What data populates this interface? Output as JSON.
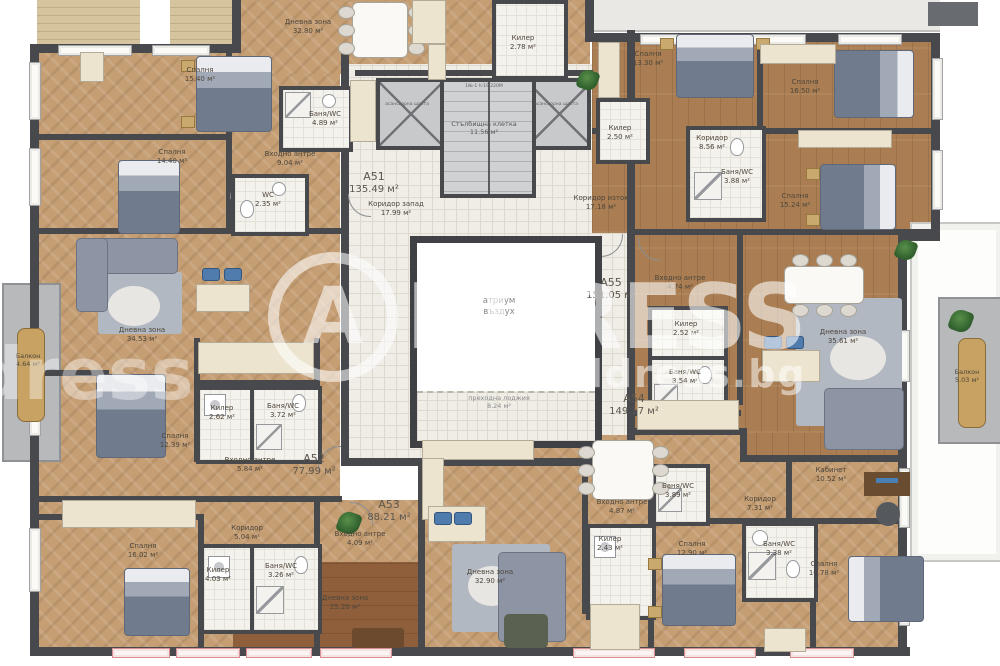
{
  "watermark": {
    "letter": "A",
    "word": "DDRESS",
    "word_partial": "address",
    "site": "address.bg"
  },
  "core": {
    "stair_name": "Стълбищна клетка",
    "stair_area": "11.56 м²",
    "stair_note": "1№-1 h:19,220М",
    "elevator": "асансьорна шахта",
    "atrium_line1": "атриум",
    "atrium_line2": "въздух",
    "loggia_name": "преходна лоджия",
    "loggia_area": "8.24 м²"
  },
  "apartments": [
    {
      "id": "A51",
      "area": "135.49 м²"
    },
    {
      "id": "A52",
      "area": "77.99 м²"
    },
    {
      "id": "A53",
      "area": "88.21 м²"
    },
    {
      "id": "A54",
      "area": "149.17 м²"
    },
    {
      "id": "A55",
      "area": "151.05 м²"
    }
  ],
  "rooms": [
    {
      "name": "Спалня",
      "area": "15.40 м²"
    },
    {
      "name": "Спалня",
      "area": "14.40 м²"
    },
    {
      "name": "Дневна зона",
      "area": "32.80 м²"
    },
    {
      "name": "Баня/WC",
      "area": "4.89 м²"
    },
    {
      "name": "Входно антре",
      "area": "9.04 м²"
    },
    {
      "name": "WC",
      "area": "2.35 м²"
    },
    {
      "name": "Килер",
      "area": "2.78 м²"
    },
    {
      "name": "Коридор запад",
      "area": "17.99 м²"
    },
    {
      "name": "Коридор изток",
      "area": "17.18 м²"
    },
    {
      "name": "Спалня",
      "area": "13.30 м²"
    },
    {
      "name": "Спалня",
      "area": "16.50 м²"
    },
    {
      "name": "Килер",
      "area": "2.50 м²"
    },
    {
      "name": "Коридор",
      "area": "8.56 м²"
    },
    {
      "name": "Баня/WC",
      "area": "3.88 м²"
    },
    {
      "name": "Спалня",
      "area": "15.24 м²"
    },
    {
      "name": "Входно антре",
      "area": "4.74 м²"
    },
    {
      "name": "Килер",
      "area": "2.52 м²"
    },
    {
      "name": "Баня/WC",
      "area": "3.54 м²"
    },
    {
      "name": "Дневна зона",
      "area": "35.61 м²"
    },
    {
      "name": "Балкон",
      "area": "4.64 м²"
    },
    {
      "name": "Балкон",
      "area": "5.03 м²"
    },
    {
      "name": "Дневна зона",
      "area": "34.53 м²"
    },
    {
      "name": "Килер",
      "area": "2.62 м²"
    },
    {
      "name": "Баня/WC",
      "area": "3.72 м²"
    },
    {
      "name": "Спалня",
      "area": "12.39 м²"
    },
    {
      "name": "Входно антре",
      "area": "5.84 м²"
    },
    {
      "name": "Спалня",
      "area": "16.02 м²"
    },
    {
      "name": "Коридор",
      "area": "5.04 м²"
    },
    {
      "name": "Килер",
      "area": "4.03 м²"
    },
    {
      "name": "Баня/WC",
      "area": "3.26 м²"
    },
    {
      "name": "Входно антре",
      "area": "4.09 м²"
    },
    {
      "name": "Дневна зона",
      "area": "25.20 м²"
    },
    {
      "name": "Дневна зона",
      "area": "32.90 м²"
    },
    {
      "name": "Входно антре",
      "area": "4.87 м²"
    },
    {
      "name": "Килер",
      "area": "2.43 м²"
    },
    {
      "name": "Спалня",
      "area": "12.90 м²"
    },
    {
      "name": "Баня/WC",
      "area": "3.89 м²"
    },
    {
      "name": "Кабинет",
      "area": "10.52 м²"
    },
    {
      "name": "Коридор",
      "area": "7.31 м²"
    },
    {
      "name": "Баня/WC",
      "area": "3.38 м²"
    },
    {
      "name": "Спалня",
      "area": "16.78 м²"
    }
  ]
}
